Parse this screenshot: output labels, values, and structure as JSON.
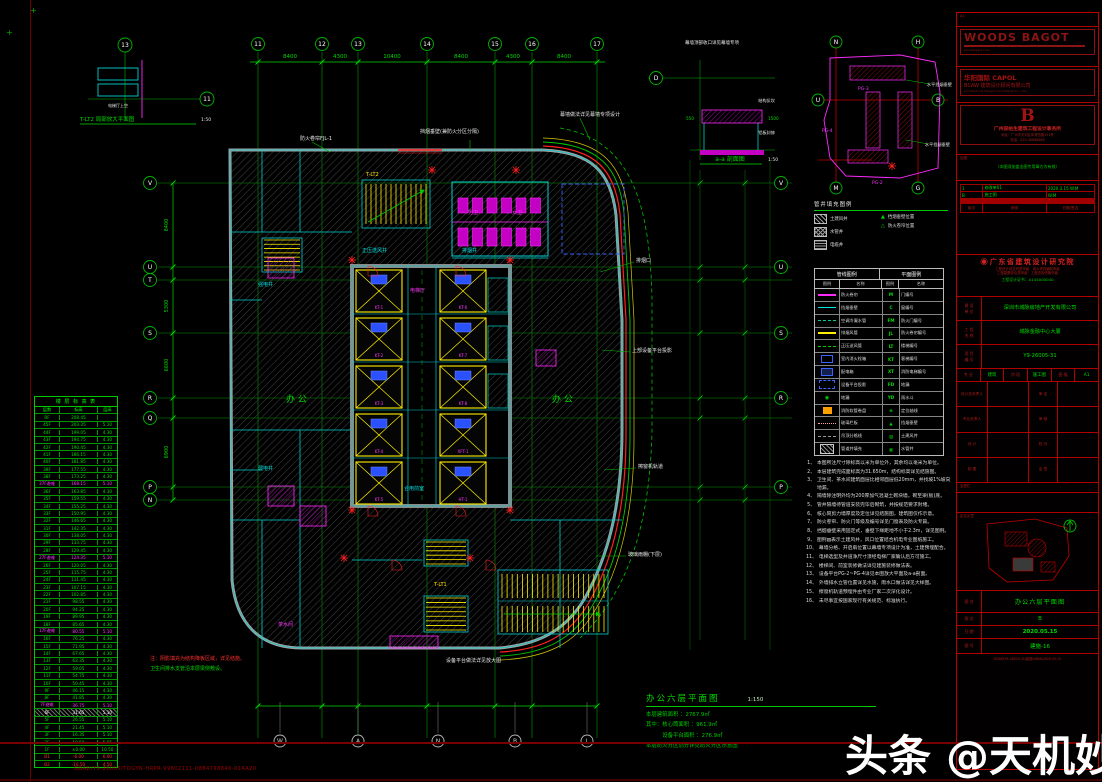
{
  "watermark": "头条 @天机妙谈",
  "sheet": {
    "bottom_left_code": "GDAD/Y9-26005/TOGYN-HRPR-99602111-0884798846-01RA20"
  },
  "plan": {
    "title": "办公六层平面图",
    "scale": "1:150",
    "stats": [
      "本层建筑面积 ：2767.9㎡",
      "其中：核心筒面积 ：961.9㎡",
      "　　　设备平台面积 ：276.9㎡",
      "本层防火分区划分详见防火分区示意图"
    ],
    "grid": {
      "top": [
        "11",
        "12",
        "13",
        "14",
        "15",
        "16",
        "17"
      ],
      "bottom": [
        "W",
        "A",
        "N",
        "B",
        "L"
      ],
      "left": [
        "V",
        "U",
        "T",
        "S",
        "R",
        "Q",
        "P",
        "N"
      ],
      "right": [
        "V",
        "U",
        "S",
        "R",
        "P"
      ],
      "top_dims": [
        "8400",
        "4300",
        "10400",
        "8400",
        "4300",
        "8400"
      ],
      "left_dims": [
        "8400",
        "5300",
        "6600",
        "6900"
      ]
    },
    "elevators": [
      "KT-1",
      "KT-2",
      "KT-3",
      "KT-4",
      "KT-5",
      "KT-6",
      "KT-7",
      "KT-8",
      "XFT-1",
      "HT-1"
    ],
    "labels": [
      {
        "x": 300,
        "y": 140,
        "t": "防火卷帘FJL-1",
        "c": "w"
      },
      {
        "x": 420,
        "y": 133,
        "t": "挡烟垂壁(兼防火分区分隔)",
        "c": "w"
      },
      {
        "x": 560,
        "y": 116,
        "t": "幕墙做法详见幕墙专项设计",
        "c": "w"
      },
      {
        "x": 636,
        "y": 262,
        "t": "排烟口",
        "c": "w"
      },
      {
        "x": 632,
        "y": 352,
        "t": "上部设备平台投影",
        "c": "w"
      },
      {
        "x": 638,
        "y": 468,
        "t": "擦窗机轨道",
        "c": "w"
      },
      {
        "x": 628,
        "y": 556,
        "t": "玻璃雨棚(下层)",
        "c": "w"
      },
      {
        "x": 362,
        "y": 252,
        "t": "正压送风井",
        "c": "c"
      },
      {
        "x": 462,
        "y": 252,
        "t": "排烟井",
        "c": "c"
      },
      {
        "x": 404,
        "y": 490,
        "t": "合用前室",
        "c": "c"
      },
      {
        "x": 410,
        "y": 292,
        "t": "电梯厅",
        "c": "m"
      },
      {
        "x": 366,
        "y": 176,
        "t": "T-LT2",
        "c": "y"
      },
      {
        "x": 434,
        "y": 586,
        "t": "T-LT1",
        "c": "y"
      },
      {
        "x": 286,
        "y": 402,
        "t": "办  公",
        "c": "g",
        "s": 9
      },
      {
        "x": 552,
        "y": 402,
        "t": "办  公",
        "c": "g",
        "s": 9
      },
      {
        "x": 468,
        "y": 214,
        "t": "男卫",
        "c": "m"
      },
      {
        "x": 512,
        "y": 214,
        "t": "女卫",
        "c": "m"
      },
      {
        "x": 258,
        "y": 286,
        "t": "强电井",
        "c": "c"
      },
      {
        "x": 258,
        "y": 470,
        "t": "弱电井",
        "c": "c"
      },
      {
        "x": 278,
        "y": 626,
        "t": "茶水间",
        "c": "m"
      },
      {
        "x": 150,
        "y": 660,
        "t": "注：阴影填充为结构降板区域，详见结施。",
        "c": "r"
      },
      {
        "x": 150,
        "y": 670,
        "t": "卫生间排水支管沿本层梁侧敷设。",
        "c": "g"
      },
      {
        "x": 446,
        "y": 662,
        "t": "设备平台做法详见放大图",
        "c": "w"
      }
    ],
    "details": {
      "lt2": {
        "title": "T-LT2 局部放大平面图",
        "scale": "1:50",
        "room": "电梯厅上空",
        "bubbles": [
          "13",
          "11"
        ]
      },
      "aa": {
        "title": "a-a 剖面图",
        "scale": "1:50",
        "top_note": "幕墙顶部收口详见幕墙专项",
        "note1": "结构反坎",
        "note2": "铝板封修",
        "dim1": "550",
        "dim2": "1500",
        "bubble": "D"
      },
      "pg": {
        "bubbles": [
          "N",
          "H",
          "U",
          "B",
          "M",
          "G"
        ],
        "tags": [
          "PG-3",
          "PG-4",
          "PG-2"
        ],
        "notes": [
          "水平挡烟垂壁",
          "水平挡烟垂壁"
        ]
      }
    }
  },
  "floor_table": {
    "title": "楼 层 标 高 表",
    "headers": [
      "层数",
      "标高",
      "层高"
    ],
    "rows": [
      [
        "RF",
        "208.45",
        "",
        ""
      ],
      [
        "45F",
        "203.35",
        "5.10",
        ""
      ],
      [
        "44F",
        "199.05",
        "4.30",
        ""
      ],
      [
        "43F",
        "194.75",
        "4.30",
        ""
      ],
      [
        "42F",
        "190.45",
        "4.30",
        ""
      ],
      [
        "41F",
        "186.15",
        "4.30",
        ""
      ],
      [
        "40F",
        "181.85",
        "4.30",
        ""
      ],
      [
        "39F",
        "177.55",
        "4.30",
        ""
      ],
      [
        "38F",
        "173.25",
        "4.30",
        ""
      ],
      [
        "37F避难",
        "168.15",
        "5.10",
        "m"
      ],
      [
        "36F",
        "163.85",
        "4.30",
        ""
      ],
      [
        "35F",
        "159.55",
        "4.30",
        ""
      ],
      [
        "34F",
        "155.25",
        "4.30",
        ""
      ],
      [
        "33F",
        "150.95",
        "4.30",
        ""
      ],
      [
        "32F",
        "146.65",
        "4.30",
        ""
      ],
      [
        "31F",
        "142.35",
        "4.30",
        ""
      ],
      [
        "30F",
        "138.05",
        "4.30",
        ""
      ],
      [
        "29F",
        "133.75",
        "4.30",
        ""
      ],
      [
        "28F",
        "129.45",
        "4.30",
        ""
      ],
      [
        "27F避难",
        "124.35",
        "5.10",
        "m"
      ],
      [
        "26F",
        "120.05",
        "4.30",
        ""
      ],
      [
        "25F",
        "115.75",
        "4.30",
        ""
      ],
      [
        "24F",
        "111.45",
        "4.30",
        ""
      ],
      [
        "23F",
        "107.15",
        "4.30",
        ""
      ],
      [
        "22F",
        "102.85",
        "4.30",
        ""
      ],
      [
        "21F",
        "98.55",
        "4.30",
        ""
      ],
      [
        "20F",
        "94.25",
        "4.30",
        ""
      ],
      [
        "19F",
        "89.95",
        "4.30",
        ""
      ],
      [
        "18F",
        "85.65",
        "4.30",
        ""
      ],
      [
        "17F避难",
        "80.55",
        "5.10",
        "m"
      ],
      [
        "16F",
        "76.25",
        "4.30",
        ""
      ],
      [
        "15F",
        "71.95",
        "4.30",
        ""
      ],
      [
        "14F",
        "67.65",
        "4.30",
        ""
      ],
      [
        "13F",
        "63.35",
        "4.30",
        ""
      ],
      [
        "12F",
        "59.05",
        "4.30",
        ""
      ],
      [
        "11F",
        "54.75",
        "4.30",
        ""
      ],
      [
        "10F",
        "50.45",
        "4.30",
        ""
      ],
      [
        "9F",
        "46.15",
        "4.30",
        ""
      ],
      [
        "8F",
        "41.85",
        "4.30",
        ""
      ],
      [
        "7F避难",
        "36.75",
        "5.10",
        "m"
      ],
      [
        "6F",
        "31.65",
        "5.10",
        "hl"
      ],
      [
        "5F",
        "26.55",
        "5.10",
        ""
      ],
      [
        "4F",
        "21.45",
        "5.10",
        ""
      ],
      [
        "3F",
        "16.35",
        "5.10",
        ""
      ],
      [
        "2F",
        "10.50",
        "5.85",
        ""
      ],
      [
        "1F",
        "±0.00",
        "10.50",
        ""
      ],
      [
        "B1",
        "-6.00",
        "6.00",
        "r"
      ],
      [
        "B2",
        "-10.50",
        "4.50",
        "r"
      ]
    ]
  },
  "legend_small": {
    "title": "管井填充图例",
    "items": [
      [
        "h1",
        "土建风井"
      ],
      [
        "h2",
        "水管井"
      ],
      [
        "h3",
        "电缆井"
      ]
    ],
    "tris": [
      [
        "▲",
        "挡烟垂壁位置"
      ],
      [
        "△",
        "防火卷帘位置"
      ]
    ]
  },
  "legend": {
    "h_left": "管线图例",
    "h_right": "平面图例",
    "sub": [
      "图例",
      "名称",
      "图例",
      "名称"
    ],
    "line_items": [
      [
        "lm",
        "防火卷帘"
      ],
      [
        "lc",
        "挡烟垂壁"
      ],
      [
        "ltd",
        "空调冷凝水管"
      ],
      [
        "ly",
        "排烟风管"
      ],
      [
        "lgd",
        "正压送风管"
      ],
      [
        "bb",
        "室内消火栓箱"
      ],
      [
        "bb2",
        "配电箱"
      ],
      [
        "bbd",
        "设备平台投影"
      ],
      [
        "sg",
        "地漏"
      ],
      [
        "bo",
        "消防软管卷盘"
      ],
      [
        "lpd",
        "玻璃栏板"
      ],
      [
        "lgr",
        "吊顶分格线"
      ],
      [
        "sh",
        "管道井填充"
      ]
    ],
    "symbol_items": [
      [
        "M",
        "门编号"
      ],
      [
        "C",
        "窗编号"
      ],
      [
        "FM",
        "防火门编号"
      ],
      [
        "JL",
        "防火卷帘编号"
      ],
      [
        "LT",
        "楼梯编号"
      ],
      [
        "KT",
        "客梯编号"
      ],
      [
        "XT",
        "消防电梯编号"
      ],
      [
        "FD",
        "地漏"
      ],
      [
        "YD",
        "雨水斗"
      ],
      [
        "⊕",
        "定位轴线"
      ],
      [
        "▲",
        "挡烟垂壁"
      ],
      [
        "▨",
        "土建风井"
      ],
      [
        "▦",
        "水管井"
      ]
    ]
  },
  "notes": {
    "items": [
      "本图所注尺寸除标高以米为单位外，其余均以毫米为单位。",
      "本层建筑完成面标高为31.650m，结构标高详见结施图。",
      "卫生间、茶水间建筑面层比相邻面层低20mm，并找坡1%坡向地漏。",
      "隔墙除注明外均为200厚加气混凝土砌块墙，砌至梁(板)底。",
      "管井隔墙待管道安装完毕后砌筑，并按规范要求封堵。",
      "核心筒剪力墙厚度及定位详见结施图，建筑图仅作示意。",
      "防火卷帘、防火门等级及编号详见门窗表及防火专篇。",
      "挡烟垂壁采用固定式，垂壁下缘距地不小于2.3m，详见图例。",
      "图例▨表示土建风井，风口位置结合机电专业图纸施工。",
      "幕墙分格、开启扇位置以幕墙专项设计为准，土建预埋配合。",
      "电梯选型及井道净尺寸须经电梯厂家确认后方可施工。",
      "楼梯间、前室装修做法详见建施装修做法表。",
      "设备平台PG-2~PG-4详见本图放大平面及a-a剖面。",
      "外墙排水立管位置详见水施，雨水口做法详见大样图。",
      "擦窗机轨道预埋件由专业厂家二次深化设计。",
      "未尽事宜按国家现行有关规范、标准执行。"
    ]
  },
  "title_block": {
    "size_tag": "A1",
    "logo1": {
      "l1": "WOODS",
      "l2": "BAGOT",
      "sub": "woodsbagot.com"
    },
    "logo2": {
      "l1": "华阳国际  CAPOL",
      "l2": "BCAW 建筑设计顾问有限公司",
      "sub": "Architectural Design Consultants Co., Ltd."
    },
    "logo3": {
      "mark": "B",
      "name": "广州容柏生建筑工程设计事务所",
      "addr": "地址：广州市天河区体育西路191号",
      "tel": "电话：020-38686868"
    },
    "out_label": "出图：",
    "stamp_note": "（本图须加盖出图专用章方为有效）",
    "revisions": {
      "rows": [
        [
          "1",
          "修改单01",
          "2020.3.15 W.M"
        ],
        [
          "B",
          "施工图",
          "W.M"
        ]
      ],
      "footer": [
        "版次",
        "说明",
        "日期/签名"
      ]
    },
    "company": {
      "seal": "◉",
      "name": "广东省建筑设计研究院",
      "cert1": "工程设计综合资质甲级　城乡规划编制甲级",
      "cert2": "工程勘察综合类甲级　工程咨询资格甲级",
      "green": "工程设计证书：A144000040"
    },
    "fields": [
      [
        "建 设\n单 位",
        "深圳市城脉房地产开发有限公司"
      ],
      [
        "工 程\n名 称",
        "城脉金融中心大厦"
      ],
      [
        "项 目\n编 号",
        "Y9-26005-31"
      ]
    ],
    "spec": [
      [
        "专 业",
        "建筑"
      ],
      [
        "阶 段",
        "施工图"
      ],
      [
        "图 幅",
        "A1"
      ]
    ],
    "sig": [
      [
        "设计总负责人",
        "审 定"
      ],
      [
        "专业负责人",
        "审 核"
      ],
      [
        "设 计",
        "校 对"
      ],
      [
        "制 图",
        "会 签"
      ]
    ],
    "huiqian": "会签栏",
    "keyplan_label": "区位示意",
    "north": "N",
    "rows": {
      "tuming_label": "图 名",
      "tuming": "办公六层平面图",
      "ver_label": "版 次",
      "ver": "B",
      "date_label": "日 期",
      "date": "2020.05.15",
      "no_label": "图 号",
      "no": "建施-16"
    },
    "bottom_code": "GDAD\\Y9-26005-31\\建施\\06RA\\2020.05.15"
  }
}
